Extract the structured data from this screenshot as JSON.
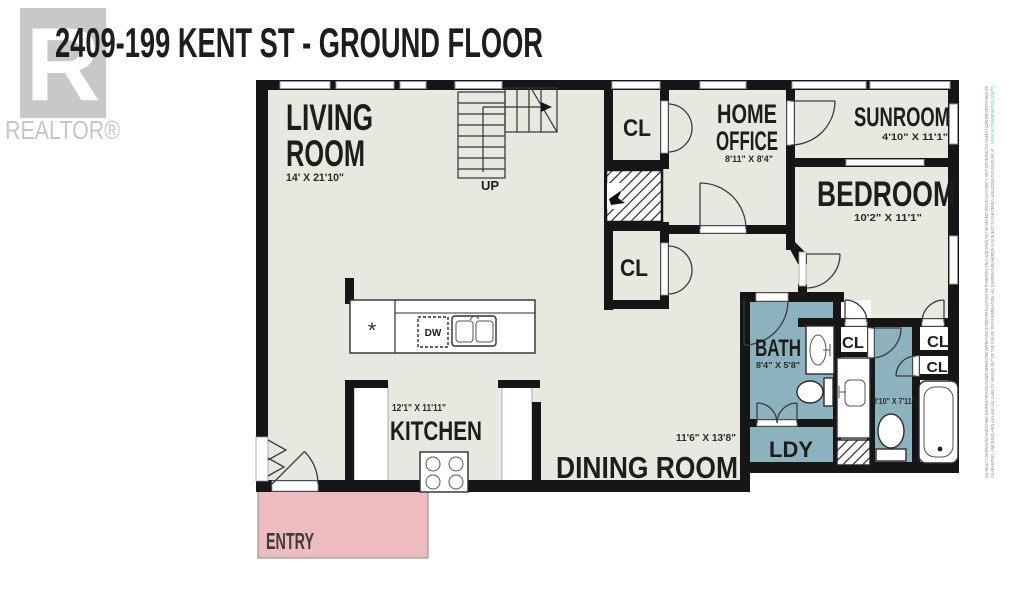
{
  "title": "2409-199 KENT ST - GROUND FLOOR",
  "branding": {
    "logo_letter": "R",
    "logo_text": "REALTOR®"
  },
  "plan": {
    "rooms": {
      "living": {
        "line1": "LIVING",
        "line2": "ROOM",
        "dims": "14' X 21'10\""
      },
      "home_office": {
        "line1": "HOME",
        "line2": "OFFICE",
        "dims": "8'11\" X 8'4\""
      },
      "sunroom": {
        "name": "SUNROOM",
        "dims": "4'10\" X 11'1\""
      },
      "bedroom": {
        "name": "BEDROOM",
        "dims": "10'2\" X 11'1\""
      },
      "kitchen": {
        "name": "KITCHEN",
        "dims": "12'1\" X 11'11\""
      },
      "dining": {
        "name": "DINING ROOM",
        "dims": "11'6\" X 13'8\""
      },
      "bath": {
        "name": "BATH",
        "dims": "8'4\" X 5'8\""
      },
      "bath2": {
        "dims": "8'10\" X 7'11\""
      },
      "laundry": {
        "name": "LDY"
      },
      "entry": {
        "name": "ENTRY"
      }
    },
    "closet_label": "CL",
    "stairs_label": "UP",
    "appliances": {
      "dishwasher": "DW",
      "fridge_symbol": "*"
    }
  },
  "disclaimer": {
    "line1": "ALL REALTY, DIMENSIONS AND OTHER INFORMATION CONTAINED HEREIN ARE APPROXIMATE AND FOR ILLUSTRATIVE PURPOSES ONLY, AND SHALL NOT BE RELIED UPON BY ANY PARTY. NEXT DOOR PHOTOS MAKES NO REPRESENTATIONS OR",
    "line2": "GUARANTEES, AND DISCLAIMS ANY AND ALL LIABILITY ARISING OUT OF THE USE OF THIS INFORMATION. ALL INFORMATION HEREIN IS SUBJECT TO THE TERMS AND CONDITIONS FOUND AT ",
    "url": "WWW.NEXTDOORPHOTOS.COM/TC"
  },
  "colors": {
    "floor": "#e8e8e0",
    "wet_area": "#8cb2bd",
    "entry": "#ecbcbf",
    "wall": "#161616",
    "logo_gray": "#c8c8c8",
    "disclaimer_gray": "#8f8f8f",
    "url_blue": "#52c4e8"
  }
}
